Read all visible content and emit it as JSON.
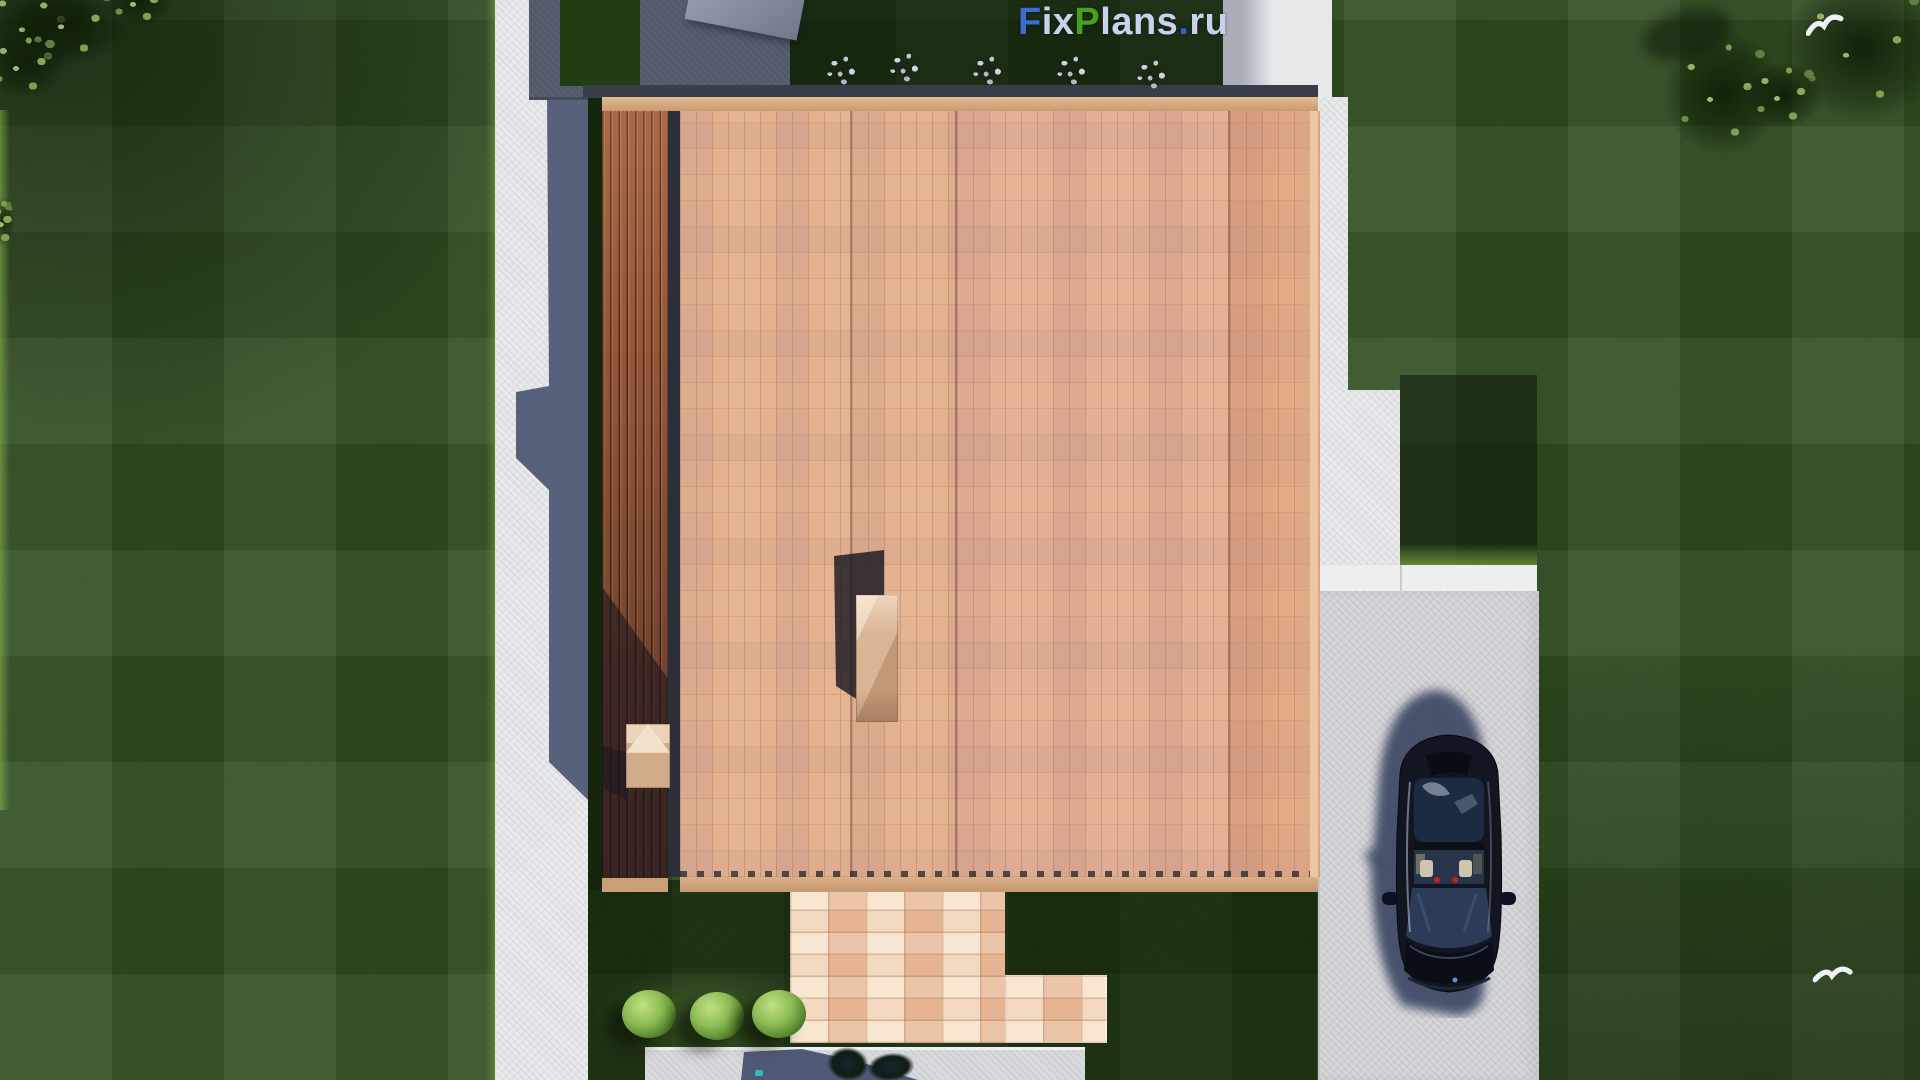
{
  "watermark": {
    "text": "FixPlans.ru",
    "segments": [
      {
        "text": "F",
        "color": "#3b6cd3"
      },
      {
        "text": "ix",
        "color": "#c9d2ec"
      },
      {
        "text": "P",
        "color": "#47a01f"
      },
      {
        "text": "lans",
        "color": "#c9d2ec"
      },
      {
        "text": ".",
        "color": "#2e63cf"
      },
      {
        "text": "ru",
        "color": "#c9d2ec"
      }
    ]
  },
  "scene": {
    "type": "aerial top-down 3D render of a single-family house site plan",
    "house": {
      "roof_material": "terracotta shingle roof",
      "roof_sections": 4,
      "roof_skylight_boxes": 2,
      "west_side": "wooden slat deck terrace",
      "north_side": "shaded concrete pad with lawn inset and bench"
    },
    "site": {
      "car": {
        "color": "#10151f",
        "location": "parked on driveway, facing south"
      },
      "driveway_color": "#d6d7d9",
      "walkway_color": "#e9eaec",
      "porch_paver_color": "#e9c6a6",
      "lawn_color": "#2f4d1e",
      "pale_shrubs_top_count": 5,
      "green_shrubs_bottom_count": 3,
      "corner_trees": [
        "top-left",
        "top-right"
      ],
      "flying_birds_count": 2
    }
  },
  "palette": {
    "roof": "#e3b190",
    "roof_dark_section": "#dda47f",
    "deck_wood": "#95573a",
    "shadow_slate": "#57617c",
    "grass_shadowed": "#16260d"
  }
}
